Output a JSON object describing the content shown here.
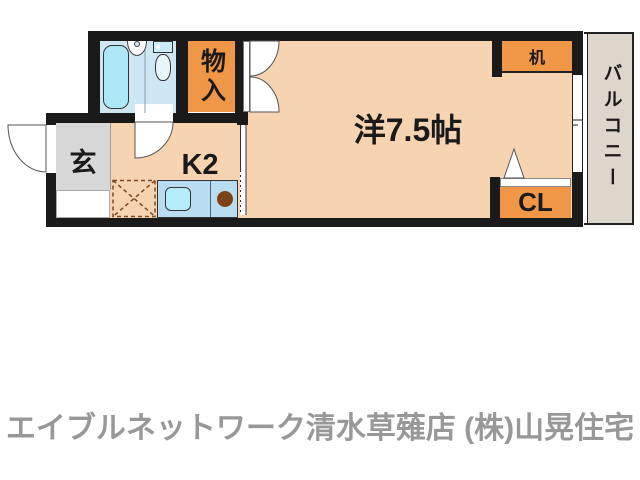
{
  "floor_plan": {
    "entrance_label": "玄",
    "kitchen_label": "K2",
    "storage_label": "物入",
    "main_room_label": "洋7.5帖",
    "desk_label": "机",
    "closet_label": "CL",
    "balcony_label": "バルコニー",
    "colors": {
      "wall": "#1a1a1a",
      "room_floor_peach": "#f6d3b1",
      "accent_orange": "#ef9647",
      "bathroom_floor_blue": "#cfe6f3",
      "bathtub_blue": "#ade6f5",
      "counter_blue": "#b9dcf1",
      "entrance_gray": "#d7d7d8",
      "balcony_beige": "#dcd6cb",
      "burner_brown": "#7d4216"
    }
  },
  "footer": {
    "agency_text": "エイブルネットワーク清水草薙店 (株)山晃住宅",
    "text_color": "#989898"
  }
}
